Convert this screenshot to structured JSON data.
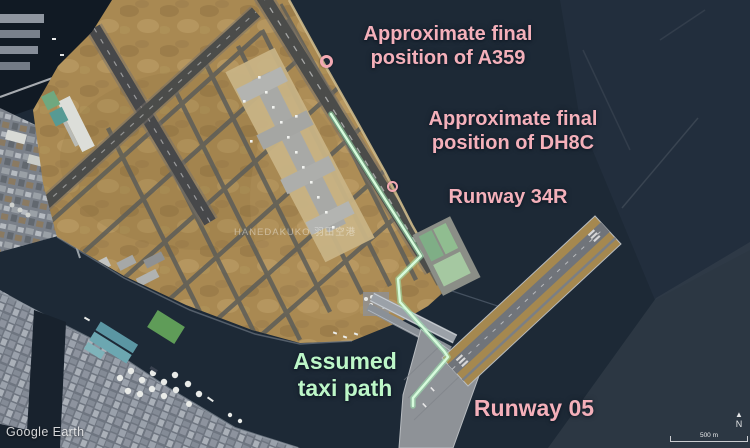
{
  "annotations": {
    "a359": {
      "line1": "Approximate final",
      "line2": "position of A359"
    },
    "dh8c": {
      "line1": "Approximate final",
      "line2": "position of DH8C"
    },
    "runway_34r": "Runway 34R",
    "taxi_path": {
      "line1": "Assumed",
      "line2": "taxi path"
    },
    "runway_05": "Runway 05"
  },
  "markers": {
    "a359_title": "Approximate final position of A359",
    "dh8c_title": "Approximate final position of DH8C"
  },
  "map": {
    "watermark": "HANEDAKUKO 羽田空港",
    "credit": "Google Earth",
    "scale_label": "500 m",
    "north_arrow": "▲",
    "north_label": "N"
  },
  "colors": {
    "annotation_pink": "#f4b0ba",
    "annotation_green": "#bdf7c8",
    "taxi_path_green": "#c6f8cf",
    "water": "#1d2936",
    "airport_land_tan": "#a98952",
    "runway_gray": "#4b4c4a"
  }
}
